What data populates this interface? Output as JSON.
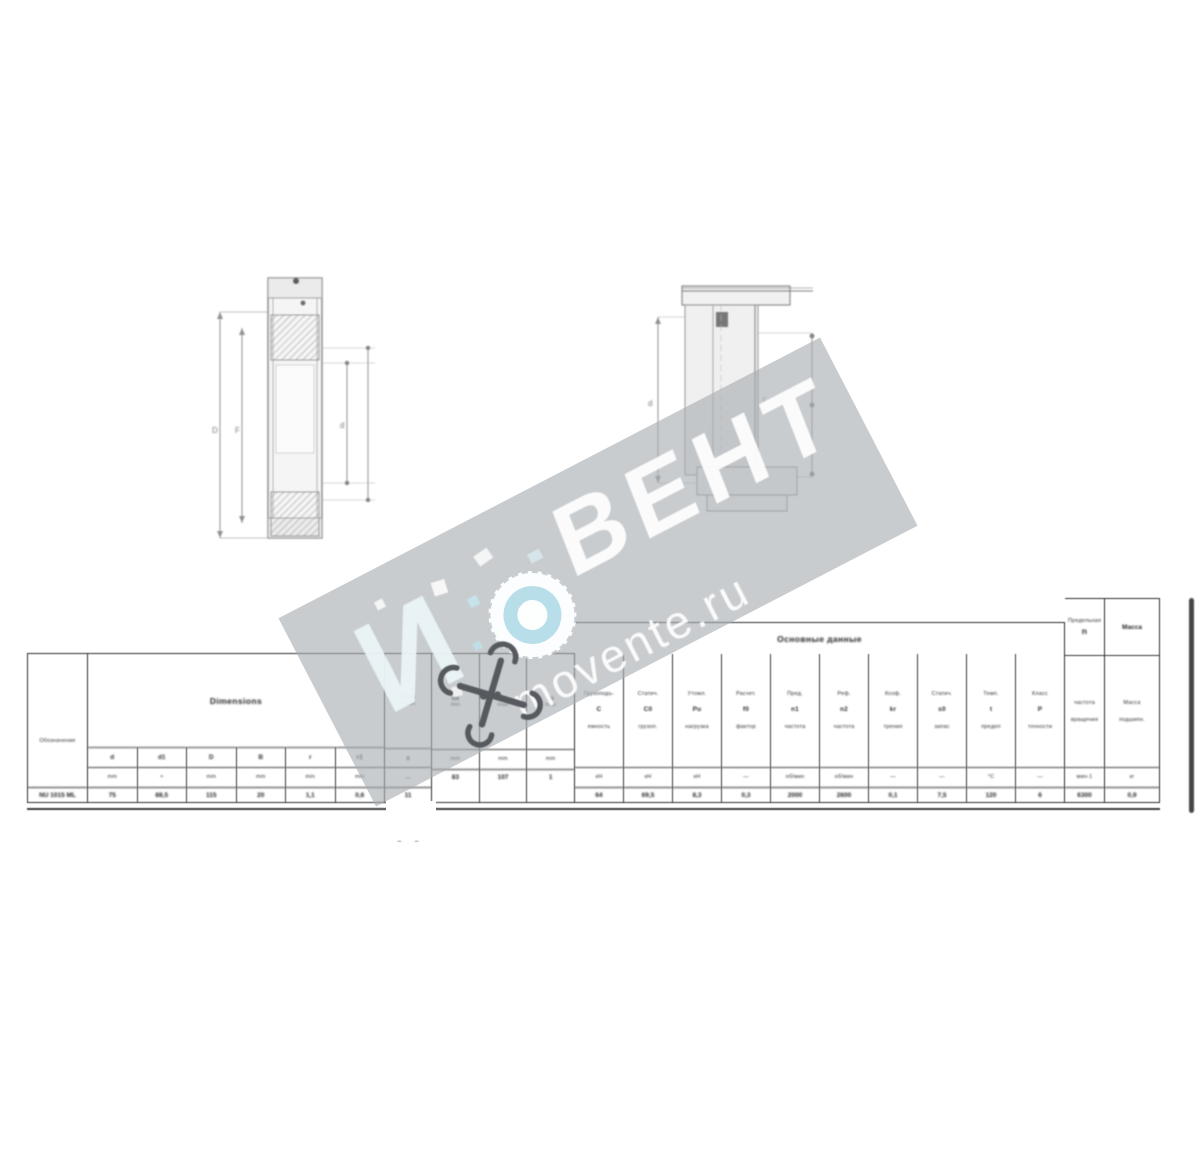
{
  "watermark": {
    "brand_letter": "И",
    "brand_name": "ВЕНТ",
    "site": "movente.ru",
    "band_color": "#a8acb1",
    "logo_ring_color": "#b8dfe9"
  },
  "drawings": {
    "section_view": {
      "label_d_outer": "D",
      "label_f": "F",
      "label_d_inner": "d",
      "label_b": "B"
    },
    "mount_view": {
      "label_left": "d",
      "label_mid1": "r",
      "label_mid2": "D"
    }
  },
  "table": {
    "designation": {
      "header": "Обозначение",
      "value": "NU 1015 ML"
    },
    "dimensions": {
      "header": "Dimensions",
      "cols": [
        {
          "label": "d",
          "unit": "mm",
          "value": "75"
        },
        {
          "label": "d1",
          "unit": "≈",
          "value": "88,5"
        },
        {
          "label": "D",
          "unit": "mm",
          "value": "115"
        },
        {
          "label": "B",
          "unit": "mm",
          "value": "20"
        },
        {
          "label": "r",
          "unit": "min",
          "value": "1,1"
        },
        {
          "label": "r1",
          "unit": "min",
          "value": "0,6"
        }
      ]
    },
    "series_col": {
      "line1": "Услов.",
      "line2": "обозн.",
      "letter": "s",
      "unit": "—",
      "value": "11"
    },
    "abutment": {
      "cols": [
        {
          "line1": "da",
          "line2": "min",
          "unit": "mm",
          "value": "83"
        },
        {
          "line1": "Da",
          "line2": "max",
          "unit": "mm",
          "value": "107"
        },
        {
          "line1": "ra",
          "line2": "max",
          "unit": "mm",
          "value": "1"
        }
      ]
    },
    "ratings": {
      "header": "Основные данные",
      "cols": [
        {
          "l1": "Грузоподъ-",
          "sym": "C",
          "l2": "емность",
          "unit": "кН",
          "value": "64"
        },
        {
          "l1": "Статич.",
          "sym": "C0",
          "l2": "грузоп.",
          "unit": "кН",
          "value": "69,5"
        },
        {
          "l1": "Утомл.",
          "sym": "Pu",
          "l2": "нагрузка",
          "unit": "кН",
          "value": "8,3"
        },
        {
          "l1": "Расчет.",
          "sym": "f0",
          "l2": "фактор",
          "unit": "—",
          "value": "0,3"
        },
        {
          "l1": "Пред.",
          "sym": "n1",
          "l2": "частота",
          "unit": "об/мин",
          "value": "2000"
        },
        {
          "l1": "Реф.",
          "sym": "n2",
          "l2": "частота",
          "unit": "об/мин",
          "value": "2600"
        },
        {
          "l1": "Коэф.",
          "sym": "kr",
          "l2": "трения",
          "unit": "—",
          "value": "0,1"
        },
        {
          "l1": "Статич.",
          "sym": "s0",
          "l2": "запас",
          "unit": "—",
          "value": "7,5"
        },
        {
          "l1": "Темп.",
          "sym": "t",
          "l2": "предел",
          "unit": "°C",
          "value": "120"
        },
        {
          "l1": "Класс",
          "sym": "P",
          "l2": "точности",
          "unit": "—",
          "value": "6"
        }
      ]
    },
    "speed_col": {
      "word": "Предельная",
      "sym": "n",
      "l1": "частота",
      "l2": "вращения",
      "unit": "мин-1",
      "value": "6300"
    },
    "mass_col": {
      "word": "Масса",
      "l1": "Масса",
      "l2": "подшипн.",
      "unit": "кг",
      "value": "0,9"
    },
    "note_marks": "– –"
  }
}
